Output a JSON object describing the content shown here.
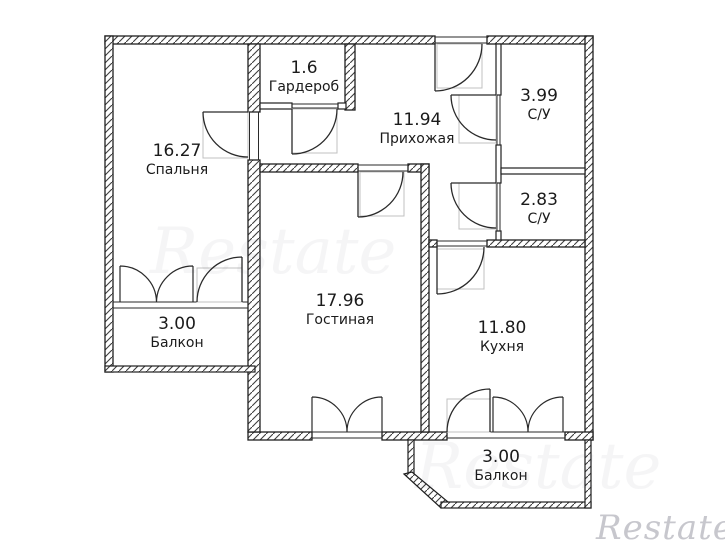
{
  "rooms": [
    {
      "id": "bedroom",
      "area": "16.27",
      "name": "Спальня"
    },
    {
      "id": "wardrobe",
      "area": "1.6",
      "name": "Гардероб"
    },
    {
      "id": "hallway",
      "area": "11.94",
      "name": "Прихожая"
    },
    {
      "id": "bathroom-large",
      "area": "3.99",
      "name": "С/У"
    },
    {
      "id": "bathroom-small",
      "area": "2.83",
      "name": "С/У"
    },
    {
      "id": "living-room",
      "area": "17.96",
      "name": "Гостиная"
    },
    {
      "id": "kitchen",
      "area": "11.80",
      "name": "Кухня"
    },
    {
      "id": "balcony-left",
      "area": "3.00",
      "name": "Балкон"
    },
    {
      "id": "balcony-bottom",
      "area": "3.00",
      "name": "Балкон"
    }
  ],
  "watermark": {
    "brand": "Restate"
  },
  "colors": {
    "wall_line": "#1f1f1f",
    "hatch_line": "#3d3d3d",
    "label_text": "#1b1b1b",
    "door_frame": "#c0c0c0",
    "watermark_text": "#c7c7cd"
  }
}
